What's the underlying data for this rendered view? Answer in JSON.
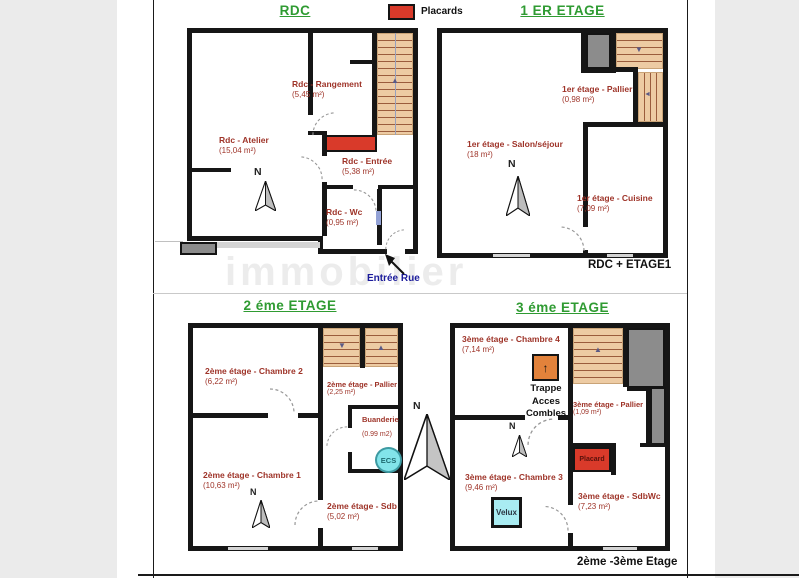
{
  "page": {
    "watermark": "immobilier"
  },
  "legend": {
    "placards": "Placards"
  },
  "compass": {
    "n": "N"
  },
  "icons": {
    "stair_up": "▲",
    "stair_down": "▼",
    "stair_left": "◄",
    "trappe_up": "↑"
  },
  "colors": {
    "title_green": "#2f9b32",
    "room_label_red": "#9e3328",
    "placard_red": "#d93a2a",
    "stairs_tan": "#edcba3",
    "stair_line_brown": "#8c482a",
    "gray_fill": "#8c8c8c",
    "ecs_cyan": "#82e4ea",
    "velux_cyan": "#a9ecf2",
    "trappe_orange": "#e2823b",
    "entrance_navy": "#1c1c9c",
    "wall_black": "#161616"
  },
  "floors": {
    "rdc": {
      "title": "RDC",
      "rooms": {
        "rangement": {
          "name": "Rdc - Rangement",
          "area": "(5,45 m²)"
        },
        "atelier": {
          "name": "Rdc - Atelier",
          "area": "(15,04 m²)"
        },
        "entree": {
          "name": "Rdc - Entrée",
          "area": "(5,38 m²)"
        },
        "wc": {
          "name": "Rdc - Wc",
          "area": "(0,95 m²)"
        }
      },
      "street_entrance": "Entrée Rue"
    },
    "etage1": {
      "title": "1 ER ETAGE",
      "rooms": {
        "pallier": {
          "name": "1er étage - Pallier",
          "area": "(0,98 m²)"
        },
        "salon": {
          "name": "1er étage - Salon/séjour",
          "area": "(18 m²)"
        },
        "cuisine": {
          "name": "1er étage - Cuisine",
          "area": "(7,09 m²)"
        }
      },
      "footer": "RDC + ETAGE1"
    },
    "etage2": {
      "title": "2 éme ETAGE",
      "rooms": {
        "chambre2": {
          "name": "2ème étage - Chambre 2",
          "area": "(6,22 m²)"
        },
        "pallier": {
          "name": "2ème étage - Pallier",
          "area": "(2,25 m²)"
        },
        "buanderie": {
          "name": "Buanderie",
          "area": "(0.99 m2)"
        },
        "chambre1": {
          "name": "2ème étage - Chambre 1",
          "area": "(10,63 m²)"
        },
        "sdb": {
          "name": "2ème étage - Sdb",
          "area": "(5,02 m²)"
        }
      },
      "ecs": "ECS"
    },
    "etage3": {
      "title": "3 éme ETAGE",
      "rooms": {
        "chambre4": {
          "name": "3ème étage - Chambre 4",
          "area": "(7,14 m²)"
        },
        "pallier": {
          "name": "3ème étage - Pallier",
          "area": "(1,09 m²)"
        },
        "chambre3": {
          "name": "3ème étage - Chambre 3",
          "area": "(9,46 m²)"
        },
        "sdbwc": {
          "name": "3ème étage - SdbWc",
          "area": "(7,23 m²)"
        }
      },
      "trappe": {
        "line1": "Trappe",
        "line2": "Acces",
        "line3": "Combles"
      },
      "placard": "Placard",
      "velux": "Velux",
      "footer": "2ème -3ème Etage"
    }
  }
}
